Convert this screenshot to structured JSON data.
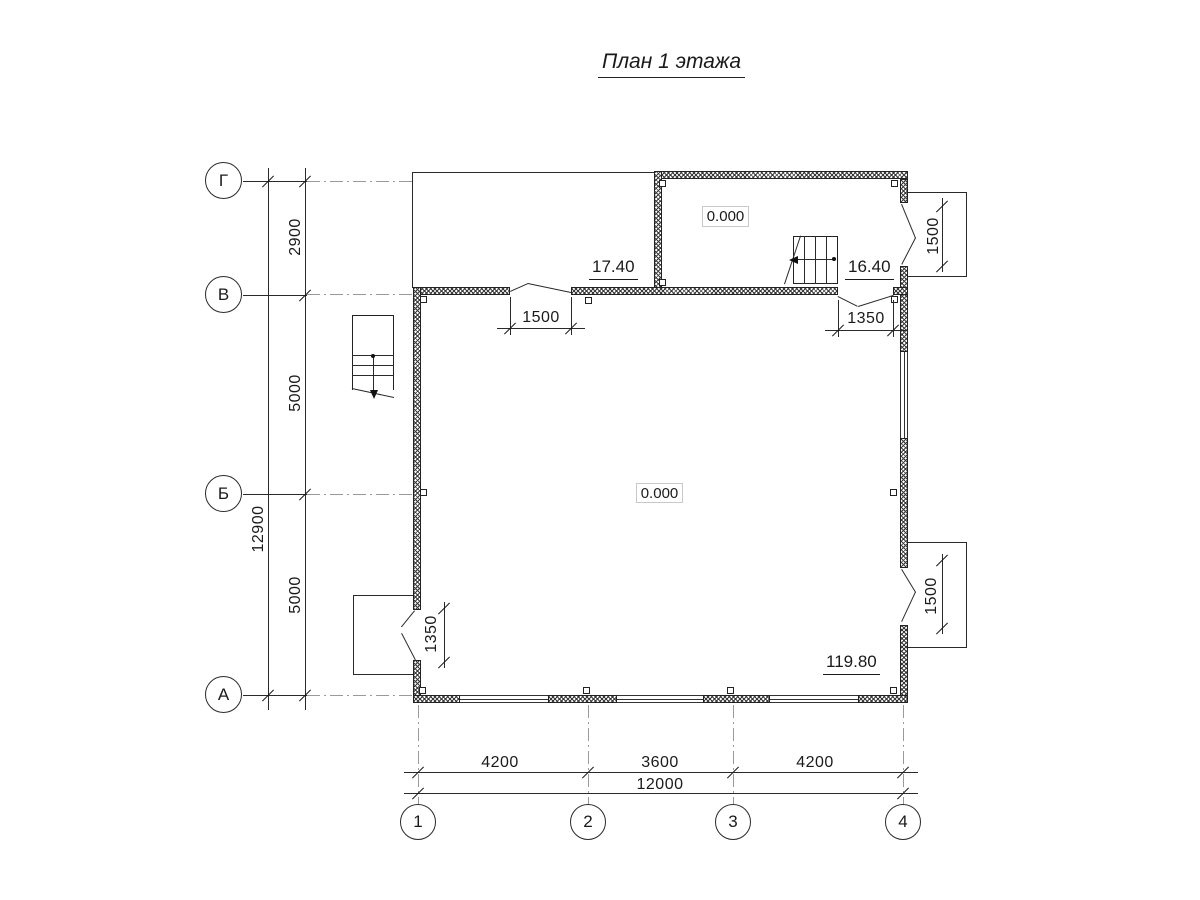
{
  "title": "План 1 этажа",
  "axes": {
    "rows": [
      {
        "label": "Г"
      },
      {
        "label": "В"
      },
      {
        "label": "Б"
      },
      {
        "label": "А"
      }
    ],
    "cols": [
      {
        "label": "1"
      },
      {
        "label": "2"
      },
      {
        "label": "3"
      },
      {
        "label": "4"
      }
    ]
  },
  "dims": {
    "left_segments": [
      "2900",
      "5000",
      "5000"
    ],
    "left_total": "12900",
    "bottom_segments": [
      "4200",
      "3600",
      "4200"
    ],
    "bottom_total": "12000",
    "door_top": "1500",
    "door_top_right": "1350",
    "balcony_top": "1500",
    "balcony_bottom": "1500",
    "porch_left": "1350"
  },
  "rooms": {
    "terrace_area": "17.40",
    "hall_area": "16.40",
    "main_area": "119.80",
    "hall_level": "0.000",
    "main_level": "0.000"
  },
  "colors": {
    "line": "#2a2a2a",
    "axis": "#9a9a9a",
    "hatch": "#3a3a3a"
  }
}
